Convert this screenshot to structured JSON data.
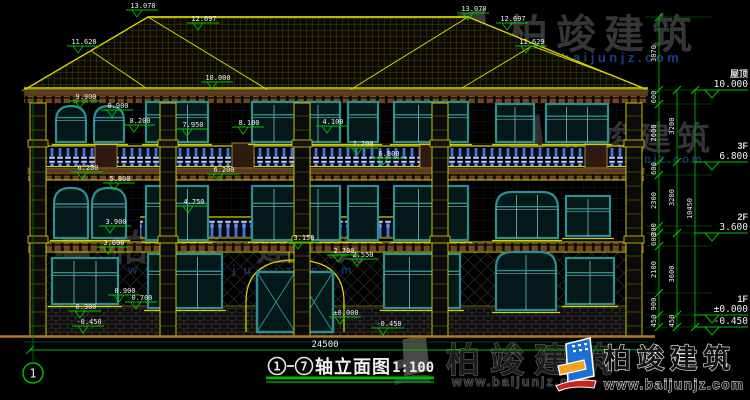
{
  "colors": {
    "background": "#000000",
    "cad_yellow": "#d4d400",
    "cad_green": "#00c400",
    "window_teal": "#2e8f8f",
    "baluster_blue": "#4f7ad0",
    "cornice_brown": "#5e3c22",
    "text_white": "#ededed",
    "watermark_gray": "#363636",
    "watermark_blue": "#1d3e86",
    "logo_blue": "#1a6fd4",
    "logo_orange": "#f5a01a",
    "logo_red": "#cc1f1f"
  },
  "title": {
    "axis_from": "1",
    "axis_to": "7",
    "separator": "—",
    "text": "轴立面图",
    "scale": "1:100"
  },
  "bottom_dim": "24500",
  "axis_bubble": "1",
  "watermark": {
    "brand": "柏竣建筑",
    "url": "www.baijunjz.com"
  },
  "logo": {
    "brand": "柏竣建筑",
    "url": "www.baijunjz.com"
  },
  "floor_markers": [
    {
      "label": "屋顶",
      "value": "10.000",
      "y": 90
    },
    {
      "label": "3F",
      "value": "6.800",
      "y": 162
    },
    {
      "label": "2F",
      "value": "3.600",
      "y": 233
    },
    {
      "label": "1F",
      "value": "±0.000",
      "y": 315
    },
    {
      "label": "",
      "value": "-0.450",
      "y": 327
    }
  ],
  "right_chains": [
    {
      "x": 659,
      "ticks": [
        17,
        90,
        104,
        162,
        175,
        226,
        233,
        246,
        293,
        315,
        327
      ],
      "values": [
        "3070",
        "600",
        "2600",
        "600",
        "2300",
        "300",
        "600",
        "2100",
        "900",
        "450"
      ]
    },
    {
      "x": 677,
      "ticks": [
        90,
        162,
        233,
        315,
        327
      ],
      "values": [
        "3200",
        "3200",
        "3600",
        "450"
      ]
    },
    {
      "x": 695,
      "ticks": [
        90,
        327
      ],
      "values": [
        "10450"
      ]
    }
  ],
  "elevation_markers": [
    {
      "t": "13.070",
      "x": 143,
      "y": 8
    },
    {
      "t": "12.697",
      "x": 204,
      "y": 21
    },
    {
      "t": "11.628",
      "x": 84,
      "y": 44
    },
    {
      "t": "13.070",
      "x": 474,
      "y": 11
    },
    {
      "t": "12.697",
      "x": 513,
      "y": 21
    },
    {
      "t": "11.629",
      "x": 532,
      "y": 44
    },
    {
      "t": "10.000",
      "x": 218,
      "y": 80
    },
    {
      "t": "9.900",
      "x": 86,
      "y": 99
    },
    {
      "t": "8.900",
      "x": 118,
      "y": 108
    },
    {
      "t": "8.200",
      "x": 140,
      "y": 123
    },
    {
      "t": "7.950",
      "x": 193,
      "y": 127
    },
    {
      "t": "8.100",
      "x": 249,
      "y": 125
    },
    {
      "t": "4.100",
      "x": 333,
      "y": 124
    },
    {
      "t": "7.200",
      "x": 363,
      "y": 146
    },
    {
      "t": "6.800",
      "x": 389,
      "y": 156
    },
    {
      "t": "6.200",
      "x": 88,
      "y": 170
    },
    {
      "t": "5.800",
      "x": 120,
      "y": 181
    },
    {
      "t": "6.200",
      "x": 224,
      "y": 172
    },
    {
      "t": "4.750",
      "x": 194,
      "y": 204
    },
    {
      "t": "3.900",
      "x": 116,
      "y": 224
    },
    {
      "t": "3.600",
      "x": 114,
      "y": 245
    },
    {
      "t": "3.150",
      "x": 304,
      "y": 240
    },
    {
      "t": "2.700",
      "x": 344,
      "y": 253
    },
    {
      "t": "2.550",
      "x": 363,
      "y": 257
    },
    {
      "t": "0.900",
      "x": 125,
      "y": 293
    },
    {
      "t": "0.700",
      "x": 142,
      "y": 300
    },
    {
      "t": "0.300",
      "x": 86,
      "y": 309
    },
    {
      "t": "±0.000",
      "x": 346,
      "y": 315
    },
    {
      "t": "-0.450",
      "x": 89,
      "y": 324
    },
    {
      "t": "-0.450",
      "x": 389,
      "y": 326
    }
  ]
}
